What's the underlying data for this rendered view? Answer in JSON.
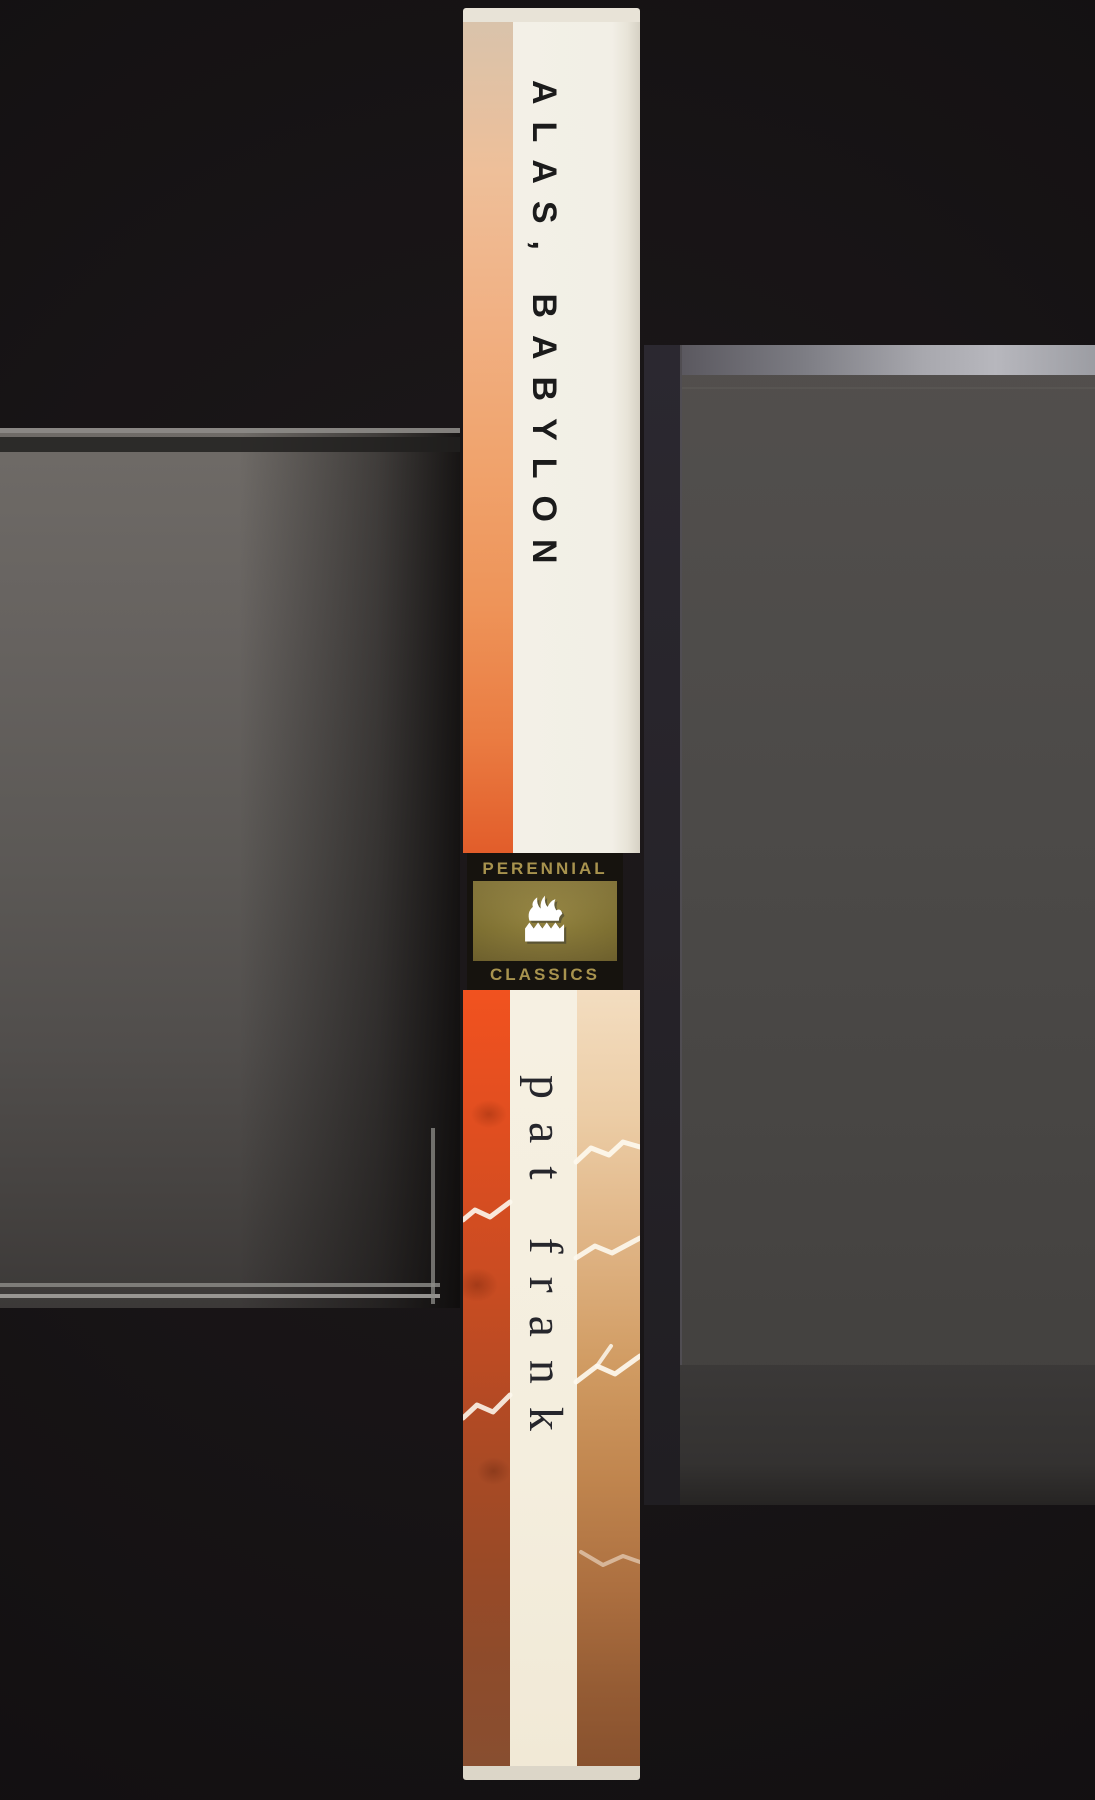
{
  "scene": {
    "description": "Scanned photograph of a paperback book spine standing upright between dark gray plastic media cases on a black scanner background"
  },
  "book_spine": {
    "title": "ALAS, BABYLON",
    "author": "pat frank",
    "imprint": {
      "top_label": "PERENNIAL",
      "bottom_label": "CLASSICS",
      "logo_icon": "flame-over-waves-icon"
    },
    "colors": {
      "spine_white": "#f2efe6",
      "orange_stripe_top": "#f0a46e",
      "orange_stripe_lower": "#e25d2a",
      "red_stripe": "#d94e22",
      "rust_bottom": "#88512e",
      "peach_stripe": "#e0b586",
      "logo_black": "#16130e",
      "logo_gold": "#85752f",
      "logo_text_gold": "#a8934e",
      "title_text": "#1b1b1b",
      "author_text": "#26262c"
    }
  },
  "background": {
    "colors": {
      "scanner_black": "#1a1618",
      "left_case_gray": "#6c6864",
      "right_case_gray": "#4a4846"
    }
  }
}
